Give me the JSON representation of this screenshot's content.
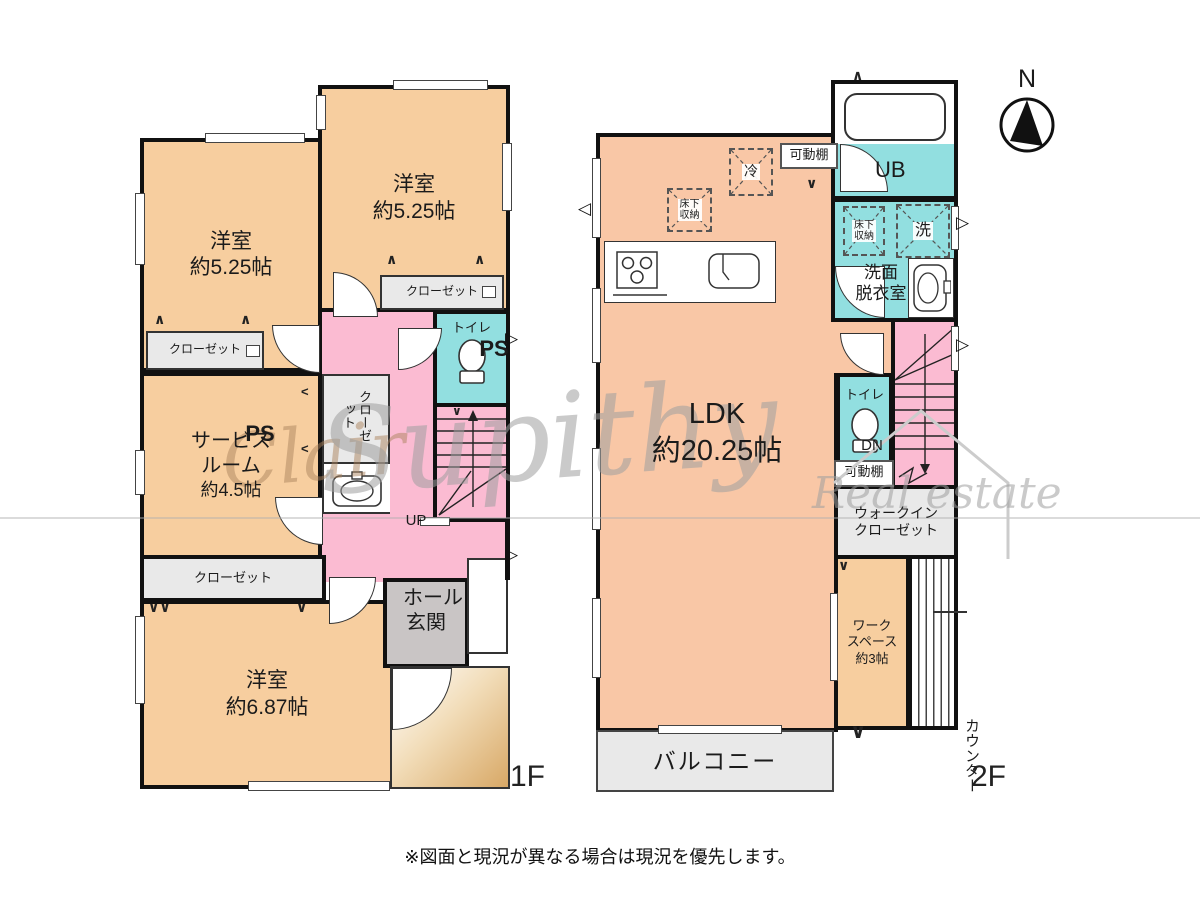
{
  "note": "※図面と現況が異なる場合は現況を優先します。",
  "compass": {
    "north": "N"
  },
  "watermark": {
    "script1": "Clair",
    "script2": "Supithy",
    "script3": "Real estate"
  },
  "symbols": {
    "fold_v": "∨",
    "fold_vv": "∨∨",
    "fold_up": "∧",
    "fold_left": "<",
    "arrow_r": "▷",
    "arrow_l": "◁"
  },
  "colors": {
    "room_beige": "#F7CE9F",
    "ldk_salmon": "#F9C7A6",
    "hall_pink": "#FBBBD2",
    "wet_cyan": "#92DFE0",
    "closet_gray": "#E9E9E9",
    "genkan_gray": "#C9C5C5",
    "wall": "#111111"
  },
  "floor1": {
    "label": "1F",
    "bedroom_a": {
      "name": "洋室",
      "size": "約5.25帖"
    },
    "bedroom_b": {
      "name": "洋室",
      "size": "約5.25帖"
    },
    "service_room": {
      "line1": "サービス",
      "line2": "ルーム",
      "line3": "約4.5帖"
    },
    "bedroom_c": {
      "name": "洋室",
      "size": "約6.87帖"
    },
    "closet_a": "クローゼット",
    "closet_b": "クローゼット",
    "closet_c": "クローゼット",
    "closet_vertical": "クローゼット",
    "ps_a": "PS",
    "ps_b": "PS",
    "toilet": "トイレ",
    "hall": "ホール",
    "up": "UP",
    "genkan": "玄関"
  },
  "floor2": {
    "label": "2F",
    "ldk": {
      "name": "LDK",
      "size": "約20.25帖"
    },
    "ub": "UB",
    "refrigerator": "冷",
    "floor_storage_ldk": {
      "line1": "床下",
      "line2": "収納"
    },
    "shelf_top": "可動棚",
    "washroom": {
      "line1": "洗面",
      "line2": "脱衣室"
    },
    "floor_storage_wash": {
      "line1": "床下",
      "line2": "収納"
    },
    "washer": "洗",
    "dn": "DN",
    "toilet": "トイレ",
    "shelf_bottom": "可動棚",
    "wic": {
      "line1": "ウォークイン",
      "line2": "クローゼット"
    },
    "workspace": {
      "line1": "ワーク",
      "line2": "スペース",
      "line3": "約3帖"
    },
    "counter": "カウンター",
    "balcony": "バルコニー"
  }
}
